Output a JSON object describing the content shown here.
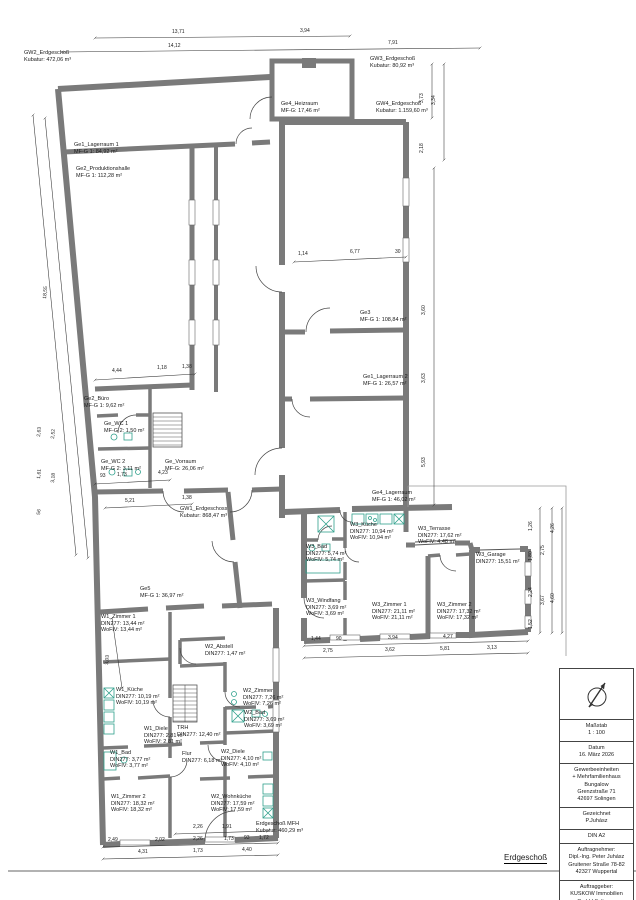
{
  "sheet": {
    "floor_label": "Erdgeschoß"
  },
  "title_block": {
    "scale_label": "Maßstab",
    "scale": "1 : 100",
    "date_label": "Datum",
    "date": "16. März 2026",
    "project": [
      "Gewerbeeinheiten",
      "+ Mehrfamilienhaus",
      "Bungalow",
      "Grenzstraße 71",
      "42697 Solingen"
    ],
    "drawn_label": "Gezeichnet",
    "drawn": "P.Juhász",
    "format": "DIN A2",
    "contractor": [
      "Auftragnehmer:",
      "Dipl.-Ing. Peter Juhász",
      "Gruitener Straße 78-82",
      "42327 Wuppertal"
    ],
    "client": [
      "Auftraggeber:",
      "KUSKOW Immobilien",
      "GmbH Solingen",
      "Kellerstrasse 6",
      "42697 Solingen"
    ]
  },
  "volumes": [
    {
      "name": "GW2_Erdgeschoß",
      "l2": "Kubatur: 472,06 m³"
    },
    {
      "name": "GW3_Erdgeschoß",
      "l2": "Kubatur: 80,92 m³"
    },
    {
      "name": "GW4_Erdgeschoß",
      "l2": "Kubatur: 1.159,60 m³"
    },
    {
      "name": "GW1_Erdgeschoss",
      "l2": "Kubatur: 868,47 m³"
    },
    {
      "name": "Erdgeschoß MFH",
      "l2": "Kubatur: 460,29 m³"
    }
  ],
  "rooms": [
    {
      "name": "Ge4_Heizraum",
      "l2": "MF-G: 17,46 m²"
    },
    {
      "name": "Ge1_Lagerraum 1",
      "l2": "MF-G 1: 84,92 m²"
    },
    {
      "name": "Ge2_Produktionshalle",
      "l2": "MF-G 1: 112,28 m²"
    },
    {
      "name": "Ge3",
      "l2": "MF-G 1: 108,84 m²"
    },
    {
      "name": "Ge1_Lagerraum 2",
      "l2": "MF-G 1: 26,57 m²"
    },
    {
      "name": "Ge2_Büro",
      "l2": "MF-G 1: 9,62 m²"
    },
    {
      "name": "Ge_WC 1",
      "l2": "MF-G 2: 1,50 m²"
    },
    {
      "name": "Ge_WC 2",
      "l2": "MF-G 2: 3,11 m²"
    },
    {
      "name": "Ge_Vorraum",
      "l2": "MF-G: 26,06 m²"
    },
    {
      "name": "Ge4_Lagerraum",
      "l2": "MF-G 1: 46,02 m²"
    },
    {
      "name": "Ge5",
      "l2": "MF-G 1: 36,97 m²"
    },
    {
      "name": "W3_Küche",
      "l2": "DIN277: 10,94 m²",
      "l3": "WoFlV: 10,94 m²"
    },
    {
      "name": "W3_Bad",
      "l2": "DIN277: 5,74 m²",
      "l3": "WoFlV: 5,74 m²"
    },
    {
      "name": "W3_Terrasse",
      "l2": "DIN277: 17,62 m²",
      "l3": "WoFlV: 4,48 m²"
    },
    {
      "name": "W3_Garage",
      "l2": "DIN277: 15,51 m²"
    },
    {
      "name": "W3_Windfang",
      "l2": "DIN277: 3,69 m²",
      "l3": "WoFlV: 3,69 m²"
    },
    {
      "name": "W3_Zimmer 1",
      "l2": "DIN277: 21,11 m²",
      "l3": "WoFlV: 21,11 m²"
    },
    {
      "name": "W3_Zimmer 2",
      "l2": "DIN277: 17,32 m²",
      "l3": "WoFlV: 17,32 m²"
    },
    {
      "name": "W1_Zimmer 1",
      "l2": "DIN277: 13,44 m²",
      "l3": "WoFlV: 13,44 m²"
    },
    {
      "name": "W2_Abstell",
      "l2": "DIN277: 1,47 m²"
    },
    {
      "name": "W1_Küche",
      "l2": "DIN277: 10,19 m²",
      "l3": "WoFlV: 10,19 m²"
    },
    {
      "name": "W2_Zimmer",
      "l2": "DIN277: 7,26 m²",
      "l3": "WoFlV: 7,26 m²"
    },
    {
      "name": "W2_Bad",
      "l2": "DIN277: 3,69 m²",
      "l3": "WoFlV: 3,69 m²"
    },
    {
      "name": "W1_Diele",
      "l2": "DIN277: 2,81 m²",
      "l3": "WoFlV: 2,81 m²"
    },
    {
      "name": "TRH",
      "l2": "DIN277: 12,40 m²"
    },
    {
      "name": "W1_Bad",
      "l2": "DIN277: 3,77 m²",
      "l3": "WoFlV: 3,77 m²"
    },
    {
      "name": "Flur",
      "l2": "DIN277: 6,18 m²"
    },
    {
      "name": "W2_Diele",
      "l2": "DIN277: 4,10 m²",
      "l3": "WoFlV: 4,10 m²"
    },
    {
      "name": "W1_Zimmer 2",
      "l2": "DIN277: 18,32 m²",
      "l3": "WoFlV: 18,32 m²"
    },
    {
      "name": "W2_Wohnküche",
      "l2": "DIN277: 17,59 m²",
      "l3": "WoFlV: 17,59 m²"
    }
  ],
  "dims": [
    "13,71",
    "3,94",
    "14,12",
    "7,91",
    "18,55",
    "2,63",
    "2,52",
    "1,61",
    "3,18",
    "56",
    "4,44",
    "1,18",
    "1,38",
    "93",
    "1,73",
    "4,23",
    "5,21",
    "1,38",
    "3,03",
    "1,14",
    "6,77",
    "30",
    "3,73",
    "3,34",
    "2,18",
    "3,60",
    "3,63",
    "5,93",
    "1,26",
    "2,75",
    "1,80",
    "4,26",
    "2,24",
    "3,67",
    "1,52",
    "4,60",
    "1,44",
    "90",
    "3,94",
    "4,27",
    "2,75",
    "3,62",
    "5,81",
    "3,13",
    "2,26",
    "1,91",
    "2,49",
    "2,02",
    "2,26",
    "1,73",
    "93",
    "1,72",
    "4,31",
    "1,73",
    "4,40"
  ]
}
